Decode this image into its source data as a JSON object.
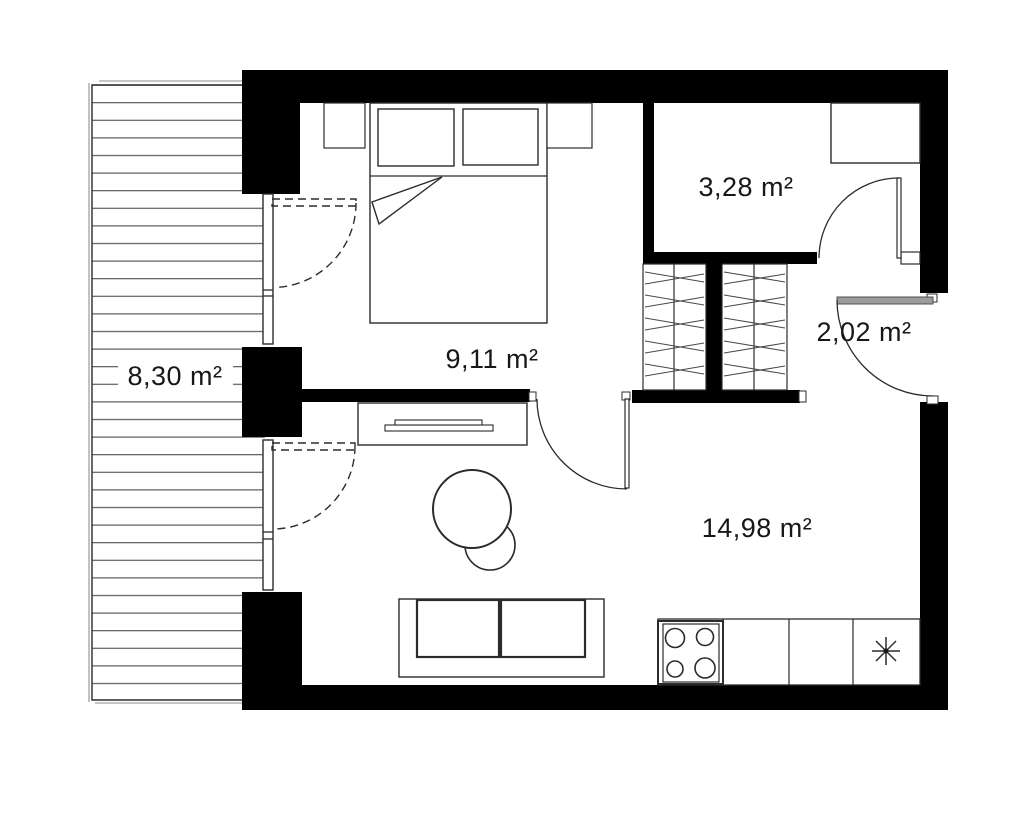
{
  "rooms": {
    "balcony": {
      "area": "8,30 m²"
    },
    "bedroom": {
      "area": "9,11 m²"
    },
    "bathroom": {
      "area": "3,28 m²"
    },
    "hallway": {
      "area": "2,02 m²"
    },
    "living_kitchen": {
      "area": "14,98 m²"
    }
  },
  "colors": {
    "wall": "#000000",
    "line": "#2b2b2b",
    "door_leaf": "#9b9b9b",
    "shadow": "#b3b3b3",
    "background": "#ffffff"
  }
}
